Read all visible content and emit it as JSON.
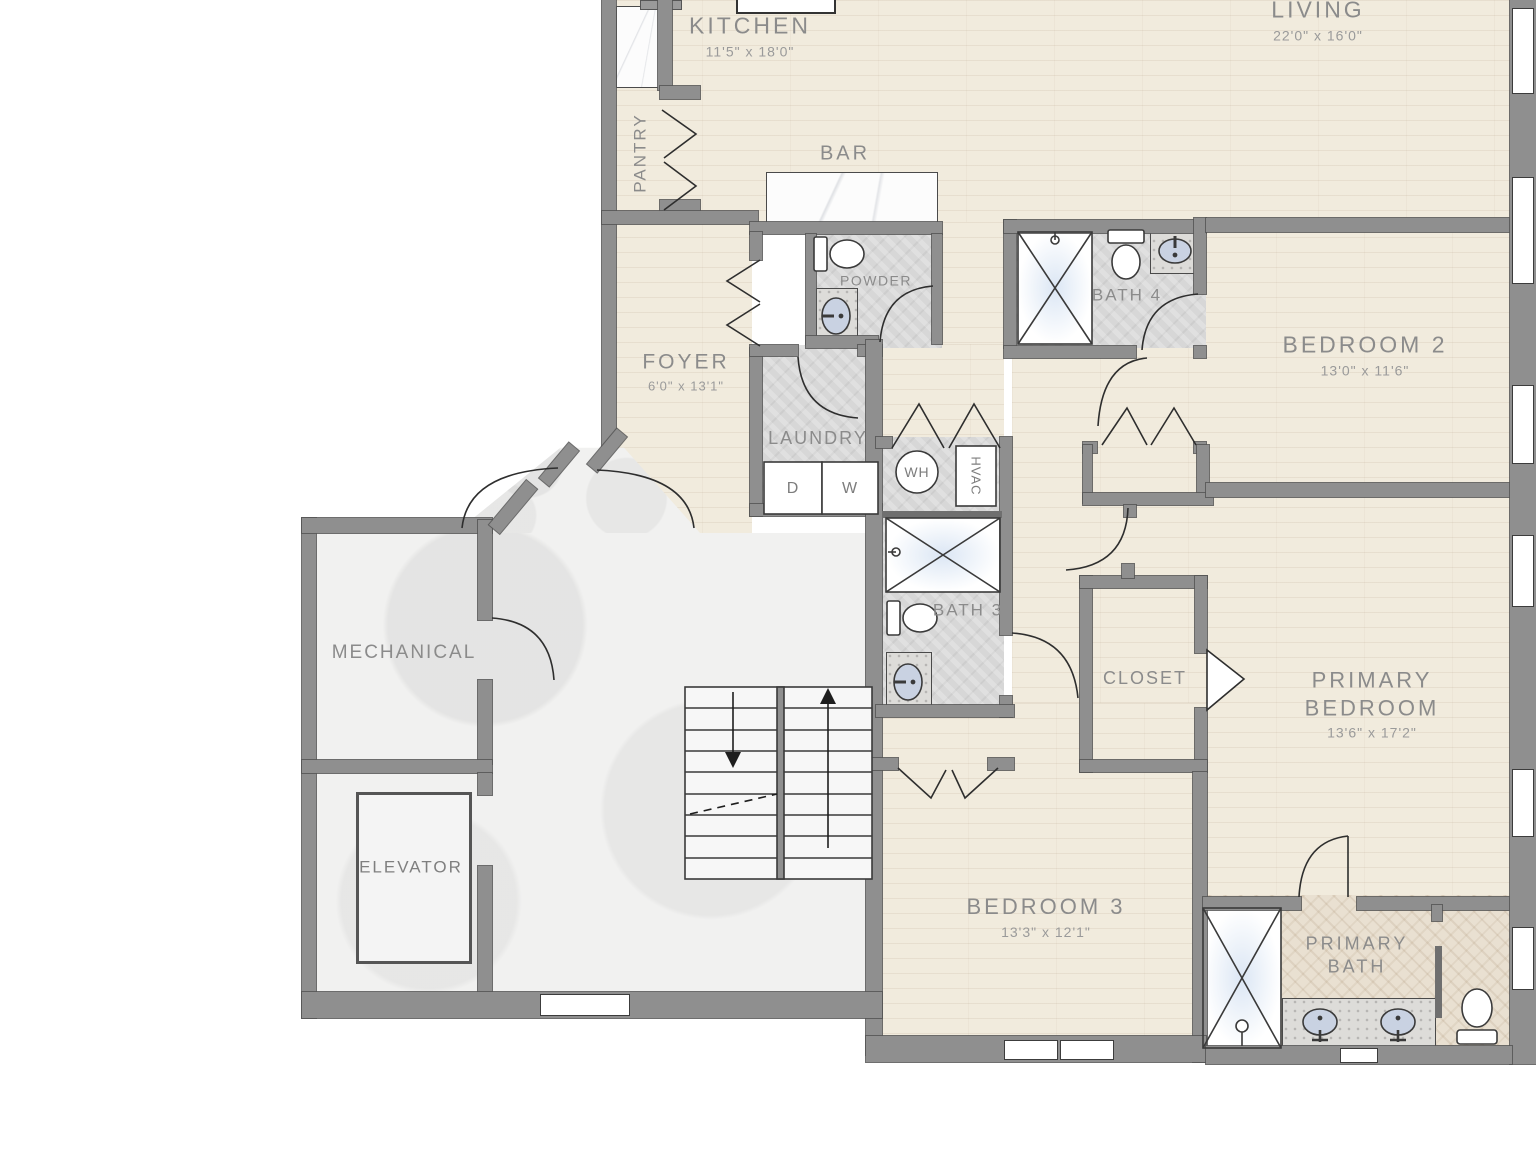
{
  "rooms": {
    "kitchen": {
      "label": "KITCHEN",
      "dims": "11'5\" x 18'0\""
    },
    "living": {
      "label": "LIVING",
      "dims": "22'0\" x 16'0\""
    },
    "pantry": {
      "label": "PANTRY"
    },
    "bar": {
      "label": "BAR"
    },
    "powder": {
      "label": "POWDER"
    },
    "bath4": {
      "label": "BATH 4"
    },
    "bedroom2": {
      "label": "BEDROOM 2",
      "dims": "13'0\" x 11'6\""
    },
    "foyer": {
      "label": "FOYER",
      "dims": "6'0\" x 13'1\""
    },
    "laundry": {
      "label": "LAUNDRY"
    },
    "bath3": {
      "label": "BATH 3"
    },
    "mechanical": {
      "label": "MECHANICAL"
    },
    "closet": {
      "label": "CLOSET"
    },
    "primary_bedroom": {
      "label": "PRIMARY BEDROOM",
      "dims": "13'6\" x 17'2\""
    },
    "elevator": {
      "label": "ELEVATOR"
    },
    "bedroom3": {
      "label": "BEDROOM 3",
      "dims": "13'3\" x 12'1\""
    },
    "primary_bath": {
      "label": "PRIMARY BATH"
    }
  },
  "appliances": {
    "dryer": "D",
    "washer": "W",
    "water_heater": "WH",
    "hvac": "HVAC"
  },
  "colors": {
    "wood_floor": "#f1ebdd",
    "bath_tile": "#d7d7d7",
    "hall_tile": "#f1f1f0",
    "herringbone_tile": "#e9e0d1",
    "wall": "#8f8f8f",
    "line": "#3a3a3a",
    "sink_basin": "#c9d2e2",
    "label_text": "#8b8b8b"
  }
}
